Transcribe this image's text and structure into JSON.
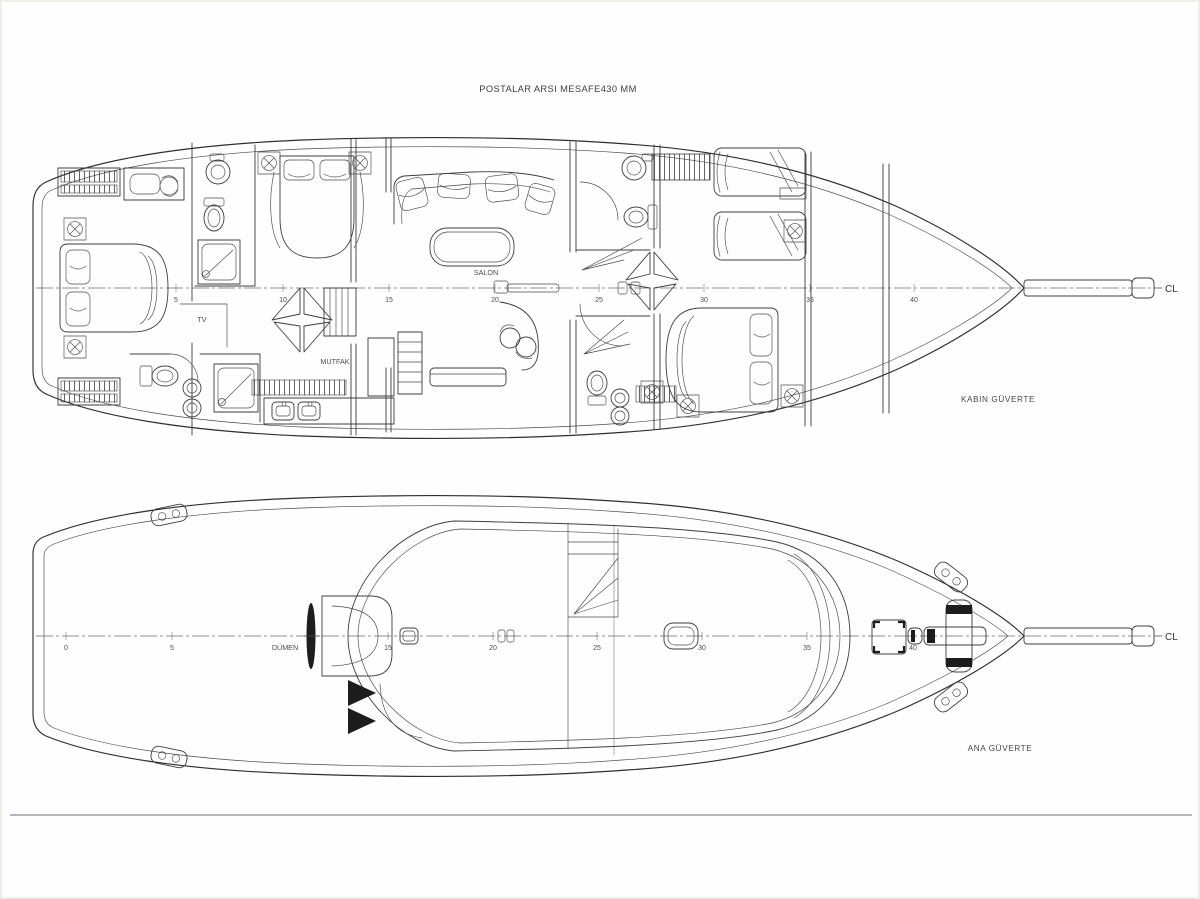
{
  "title": "POSTALAR ARSI MESAFE430 MM",
  "cabin_deck": {
    "deck_label": "KABIN GÜVERTE",
    "centerline_label": "CL",
    "room_labels": {
      "salon": "SALON",
      "tv": "TV",
      "galley": "MUTFAK"
    },
    "stations": [
      "5",
      "10",
      "15",
      "20",
      "25",
      "30",
      "35",
      "40"
    ]
  },
  "main_deck": {
    "deck_label": "ANA GÜVERTE",
    "centerline_label": "CL",
    "room_labels": {
      "helm": "DÜMEN"
    },
    "stations": [
      "0",
      "5",
      "15",
      "20",
      "25",
      "30",
      "35",
      "40"
    ]
  }
}
